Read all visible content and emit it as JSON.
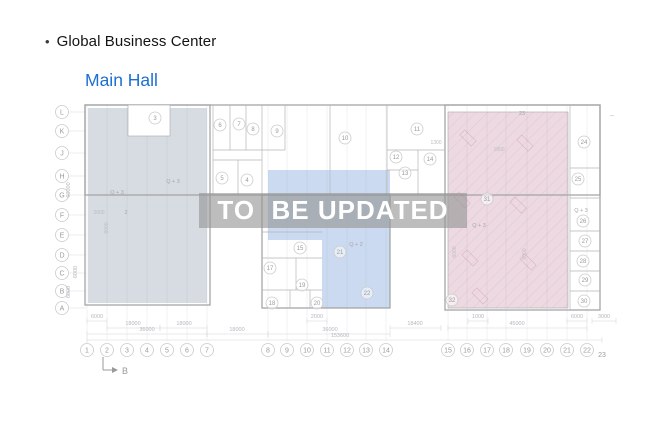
{
  "header": {
    "bullet": "•",
    "title": "Global Business Center",
    "subtitle": "Main Hall",
    "accent": "#1c6fd4"
  },
  "watermark": {
    "text": "TO  BE UPDATED"
  },
  "plan": {
    "row_labels": [
      "L",
      "K",
      "J",
      "H",
      "G",
      "F",
      "E",
      "D",
      "C",
      "B",
      "A"
    ],
    "col_labels": [
      "1",
      "2",
      "3",
      "4",
      "5",
      "6",
      "7",
      "8",
      "9",
      "10",
      "11",
      "12",
      "13",
      "14",
      "15",
      "16",
      "17",
      "18",
      "19",
      "20",
      "21",
      "22"
    ],
    "col_label_23": "23",
    "rooms": [
      "3",
      "6",
      "7",
      "8",
      "9",
      "10",
      "11",
      "12",
      "13",
      "14",
      "5",
      "4",
      "15",
      "17",
      "19",
      "18",
      "20",
      "21",
      "22",
      "24",
      "25",
      "26",
      "27",
      "28",
      "29",
      "30",
      "31",
      "32"
    ],
    "annotations": [
      "Q + 3",
      "Q + 3",
      "2",
      "Q + 2",
      "Q + 3",
      "Q + 3",
      "23"
    ],
    "dimensions_bottom": [
      "6000",
      "2000",
      "1000",
      "6000",
      "3000",
      "18000",
      "18000",
      "18400",
      "45000",
      "36000",
      "18000",
      "36000",
      "153600"
    ],
    "dimensions_side": [
      "60000",
      "6000",
      "6000"
    ],
    "dimensions_inner": [
      "1300",
      "1800",
      "2600",
      "9000",
      "6000",
      "6000"
    ],
    "section_marker": "B",
    "dash_note": "–",
    "colors": {
      "left_zone": "#ccd3db",
      "middle_zone": "#bed1ec",
      "right_zone": "#e9d0da",
      "hatch": "#d9afbe"
    }
  }
}
